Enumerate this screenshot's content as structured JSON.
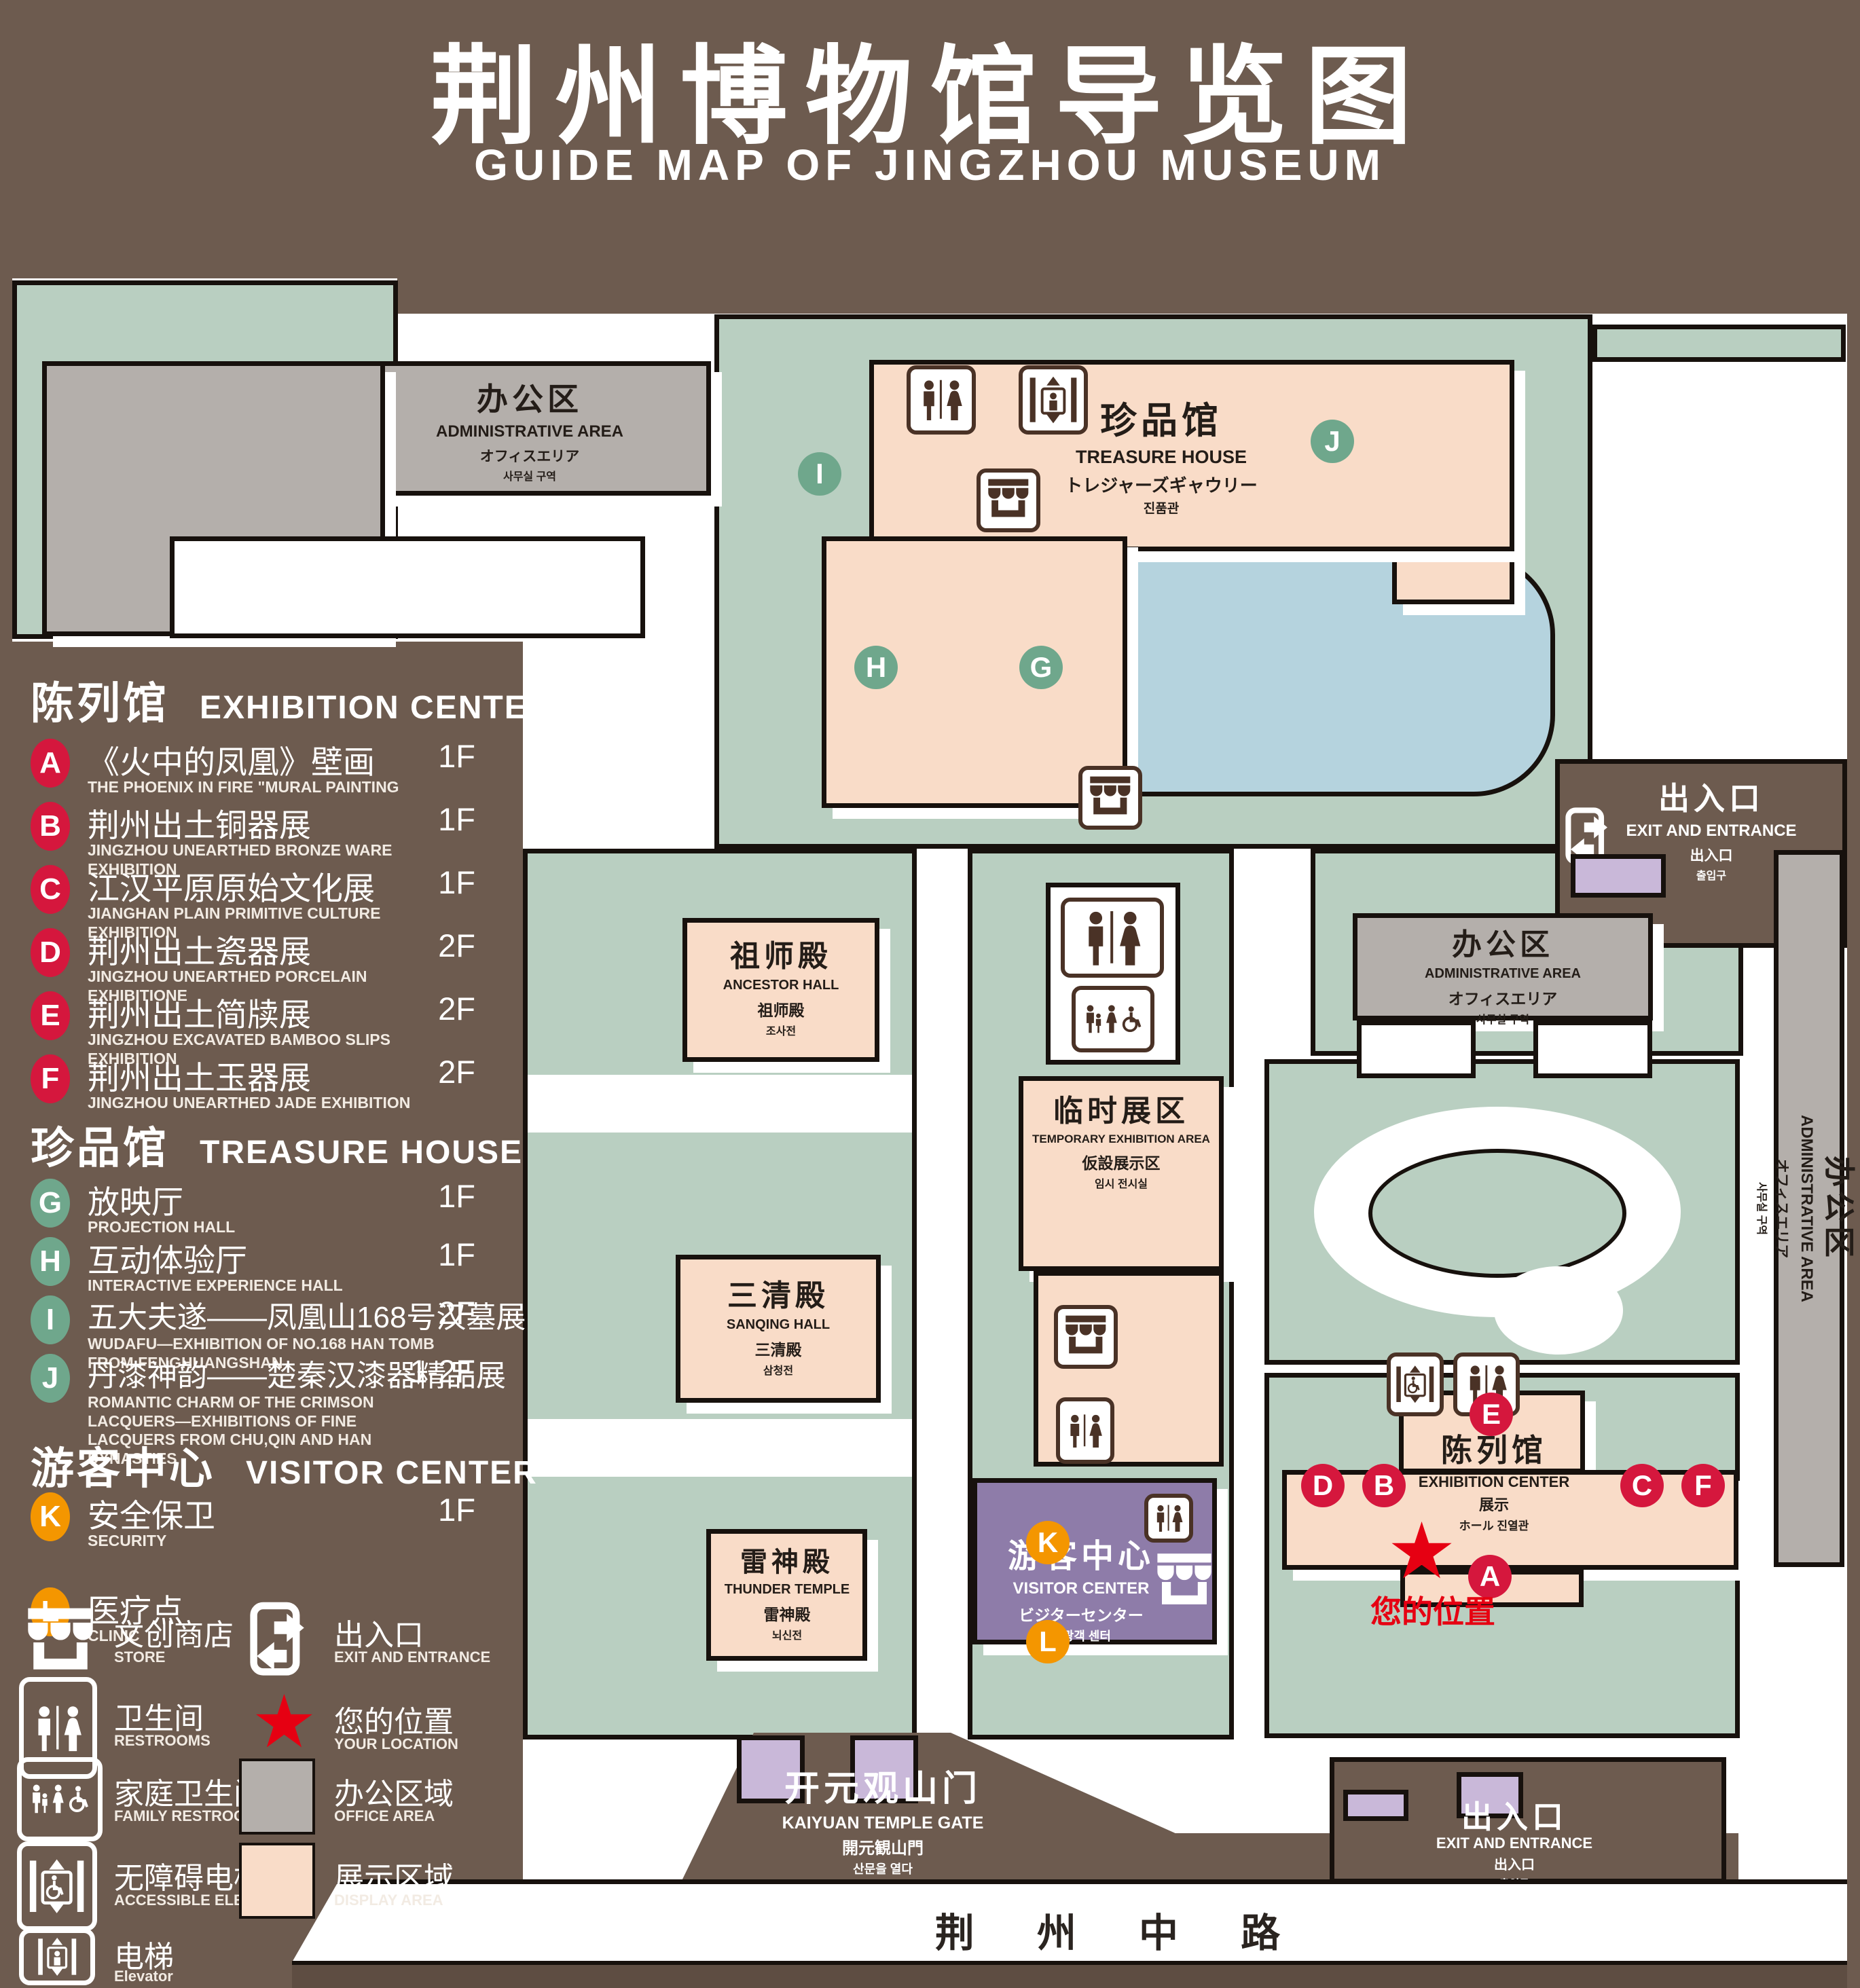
{
  "title": {
    "zh": "荆州博物馆导览图",
    "en": "GUIDE MAP OF JINGZHOU MUSEUM"
  },
  "legend": {
    "sections": [
      {
        "zh": "陈列馆",
        "en": "EXHIBITION CENTER",
        "items": [
          {
            "id": "A",
            "zh": "《火中的凤凰》壁画",
            "en": "THE PHOENIX IN FIRE \"MURAL PAINTING",
            "floor": "1F"
          },
          {
            "id": "B",
            "zh": "荆州出土铜器展",
            "en": "JINGZHOU UNEARTHED BRONZE WARE EXHIBITION",
            "floor": "1F"
          },
          {
            "id": "C",
            "zh": "江汉平原原始文化展",
            "en": "JIANGHAN PLAIN PRIMITIVE CULTURE EXHIBITION",
            "floor": "1F"
          },
          {
            "id": "D",
            "zh": "荆州出土瓷器展",
            "en": "JINGZHOU UNEARTHED PORCELAIN EXHIBITIONE",
            "floor": "2F"
          },
          {
            "id": "E",
            "zh": "荆州出土简牍展",
            "en": "JINGZHOU EXCAVATED BAMBOO SLIPS EXHIBITION",
            "floor": "2F"
          },
          {
            "id": "F",
            "zh": "荆州出土玉器展",
            "en": "JINGZHOU UNEARTHED JADE EXHIBITION",
            "floor": "2F"
          }
        ]
      },
      {
        "zh": "珍品馆",
        "en": "TREASURE HOUSE",
        "items": [
          {
            "id": "G",
            "zh": "放映厅",
            "en": "PROJECTION HALL",
            "floor": "1F"
          },
          {
            "id": "H",
            "zh": "互动体验厅",
            "en": "INTERACTIVE EXPERIENCE HALL",
            "floor": "1F"
          },
          {
            "id": "I",
            "zh": "五大夫遂——凤凰山168号汉墓展",
            "en": "WUDAFU—EXHIBITION OF NO.168 HAN TOMB FROM FENGHUANGSHAN",
            "floor": "2F"
          },
          {
            "id": "J",
            "zh": "丹漆神韵——楚秦汉漆器精品展",
            "en": "ROMANTIC CHARM OF THE CRIMSON LACQUERS—EXHIBITIONS OF FINE LACQUERS FROM CHU,QIN AND HAN DYNASTIES",
            "floor": "1-2F"
          }
        ]
      },
      {
        "zh": "游客中心",
        "en": "VISITOR CENTER",
        "items": [
          {
            "id": "K",
            "zh": "安全保卫",
            "en": "SECURITY",
            "floor": "1F"
          },
          {
            "id": "L",
            "zh": "医疗点",
            "en": "CLINIC",
            "floor": "1F"
          }
        ]
      }
    ],
    "symbols": {
      "store": {
        "zh": "文创商店",
        "en": "STORE"
      },
      "exit": {
        "zh": "出入口",
        "en": "EXIT AND ENTRANCE"
      },
      "restrooms": {
        "zh": "卫生间",
        "en": "RESTROOMS"
      },
      "location": {
        "zh": "您的位置",
        "en": "YOUR LOCATION"
      },
      "family": {
        "zh": "家庭卫生间",
        "en": "FAMILY RESTROOMS"
      },
      "office": {
        "zh": "办公区域",
        "en": "OFFICE AREA"
      },
      "accessible": {
        "zh": "无障碍电梯",
        "en": "ACCESSIBLE ELEVATOR"
      },
      "display": {
        "zh": "展示区域",
        "en": "DISPLAY AREA"
      },
      "elevator": {
        "zh": "电梯",
        "en": "Elevator"
      }
    }
  },
  "map": {
    "admin_nw": {
      "zh": "办公区",
      "en": "ADMINISTRATIVE AREA",
      "jp": "オフィスエリア",
      "kr": "사무실 구역"
    },
    "treasure": {
      "zh": "珍品馆",
      "en": "TREASURE HOUSE",
      "jp": "トレジャーズギャウリー",
      "kr": "진품관"
    },
    "ancestor": {
      "zh": "祖师殿",
      "en": "ANCESTOR HALL",
      "jp": "祖师殿",
      "kr": "조사전"
    },
    "temporary": {
      "zh": "临时展区",
      "en": "TEMPORARY EXHIBITION AREA",
      "jp": "仮設展示区",
      "kr": "임시 전시실"
    },
    "sanqing": {
      "zh": "三清殿",
      "en": "SANQING HALL",
      "jp": "三清殿",
      "kr": "삼청전"
    },
    "thunder": {
      "zh": "雷神殿",
      "en": "THUNDER TEMPLE",
      "jp": "雷神殿",
      "kr": "뇌신전"
    },
    "admin_e": {
      "zh": "办公区",
      "en": "ADMINISTRATIVE AREA",
      "jp": "オフィスエリア",
      "kr": "사무실 구역"
    },
    "admin_strip": {
      "zh": "办公区",
      "en": "ADMINISTRATIVE AREA",
      "jp": "オフィスエリア",
      "kr": "사무실 구역"
    },
    "exhibition": {
      "zh": "陈列馆",
      "en": "EXHIBITION CENTER",
      "jp": "展示",
      "kr": "ホール 진열관"
    },
    "visitor": {
      "zh": "游客中心",
      "en": "VISITOR CENTER",
      "jp": "ビジターセンター",
      "kr": "관광객 센터"
    },
    "exit_ne": {
      "zh": "出入口",
      "en": "EXIT AND ENTRANCE",
      "jp": "出入口",
      "kr": "출입구"
    },
    "exit_s": {
      "zh": "出入口",
      "en": "EXIT AND ENTRANCE",
      "jp": "出入口",
      "kr": "출입구"
    },
    "gate": {
      "zh": "开元观山门",
      "en": "KAIYUAN TEMPLE GATE",
      "jp": "開元観山門",
      "kr": "산문을 열다"
    },
    "road": "荆 州 中 路",
    "your_location": "您的位置",
    "badges": {
      "A": "A",
      "B": "B",
      "C": "C",
      "D": "D",
      "E": "E",
      "F": "F",
      "G": "G",
      "H": "H",
      "I": "I",
      "J": "J",
      "K": "K",
      "L": "L"
    }
  },
  "colors": {
    "background": "#6d5b4f",
    "map_green": "#b9cfc1",
    "display_area": "#f9dcc8",
    "office_area": "#b4afab",
    "visitor_purple": "#8e7ca9",
    "small_building_lilac": "#c9b8d9",
    "pond_blue": "#b5d3de",
    "badge_red": "#d5173d",
    "badge_green": "#6fa78c",
    "badge_orange": "#f49600",
    "location_red": "#e60012"
  }
}
